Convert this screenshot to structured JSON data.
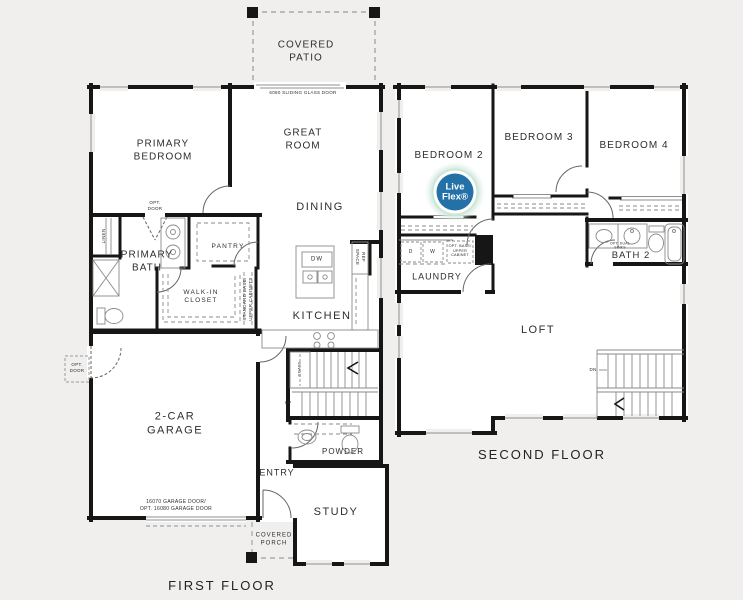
{
  "page": {
    "background": "#f0efed",
    "plan_fill": "#ffffff",
    "wall_color": "#161616",
    "detail_line_color": "#8a8a8a",
    "text_color": "#2d2d2d",
    "badge_blue": "#2471a7",
    "badge_glow_green": "#cce7da"
  },
  "first_floor": {
    "title": "FIRST FLOOR",
    "labels": {
      "covered_patio": "COVERED\nPATIO",
      "sliding_door_note": "6080 SLIDING GLASS DOOR",
      "primary_bedroom": "PRIMARY\nBEDROOM",
      "great_room": "GREAT\nROOM",
      "dining": "DINING",
      "opt_door_bath": "OPT.\nDOOR",
      "linen": "LINEN",
      "primary_bath": "PRIMARY\nBATH",
      "pantry": "PANTRY",
      "walk_in_closet": "WALK-IN\nCLOSET",
      "cabinets_note": "STANDARD BASE/\nUPPER CABINETS",
      "dishwasher": "DW",
      "ref_space": "REF\nSPACE",
      "kitchen": "KITCHEN",
      "garage": "2-CAR\nGARAGE",
      "opt_door_garage": "OPT.\nDOOR",
      "coats": "COATS",
      "up": "UP",
      "garage_door_note": "16070 GARAGE DOOR/\nOPT. 16080 GARAGE DOOR",
      "entry": "ENTRY",
      "powder": "POWDER",
      "study": "STUDY",
      "covered_porch": "COVERED\nPORCH"
    }
  },
  "second_floor": {
    "title": "SECOND FLOOR",
    "badge": "Live\nFlex®",
    "labels": {
      "bedroom2": "BEDROOM 2",
      "bedroom3": "BEDROOM 3",
      "bedroom4": "BEDROOM 4",
      "dryer": "D",
      "washer": "W",
      "laundry_cabinet_note": "OPT. BASE/\nUPPER\nCABINET",
      "laundry": "LAUNDRY",
      "bath2": "BATH 2",
      "bath2_note": "OPT. DUAL\nSINKS",
      "loft": "LOFT",
      "down": "DN"
    }
  }
}
